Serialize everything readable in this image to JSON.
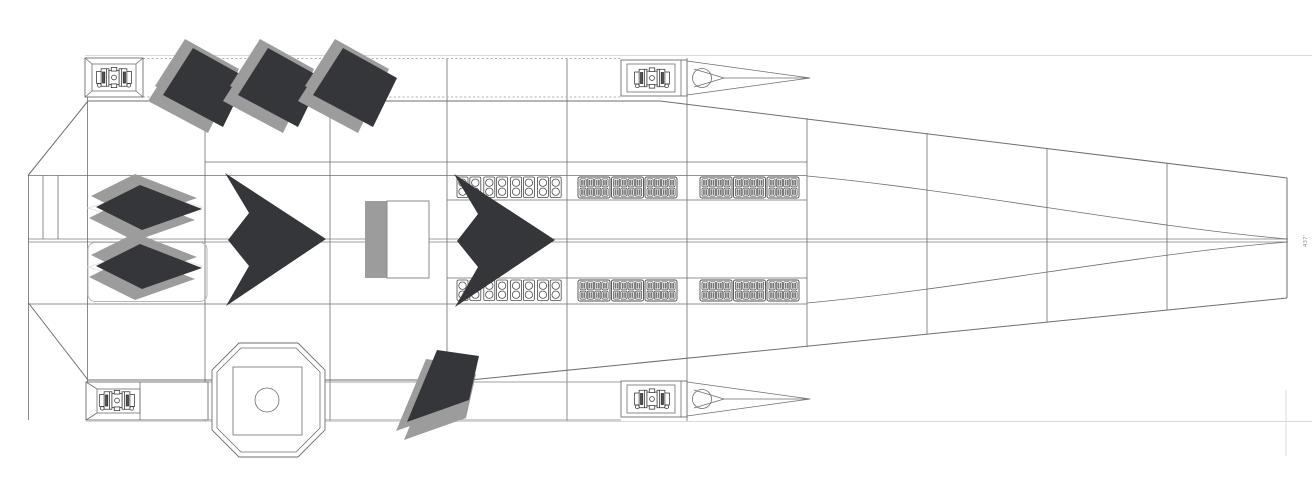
{
  "annotation": {
    "dimension_label": "437'"
  },
  "palette": {
    "ink": "#6e6e6e",
    "ink_light": "#9f9f9f",
    "faint": "#d9d9d9",
    "acdark": "#35363a",
    "acgray": "#9c9c9c",
    "module": "#4a4a4a"
  },
  "fleet": {
    "flying_wing_aircraft": [
      {
        "x": 326,
        "y": 239
      },
      {
        "x": 555,
        "y": 240
      }
    ],
    "tilted_diamond_drones": [
      {
        "x": 205,
        "y": 88
      },
      {
        "x": 280,
        "y": 88
      },
      {
        "x": 355,
        "y": 88
      },
      {
        "x": 443,
        "y": 388,
        "variant": "down"
      }
    ],
    "flat_diamond_drones": [
      {
        "x": 148,
        "y": 208,
        "pad": false
      },
      {
        "x": 148,
        "y": 267,
        "pad": true
      }
    ]
  },
  "deck_modules": {
    "rows_y": [
      177,
      280
    ],
    "circle_cell_group": {
      "x": 457,
      "cells": 8
    },
    "bench_groups": [
      {
        "x": 578,
        "modules": 3
      },
      {
        "x": 700,
        "modules": 3
      }
    ],
    "bench_layout": {
      "seat_rows": 2,
      "seat_cols": 4
    }
  }
}
